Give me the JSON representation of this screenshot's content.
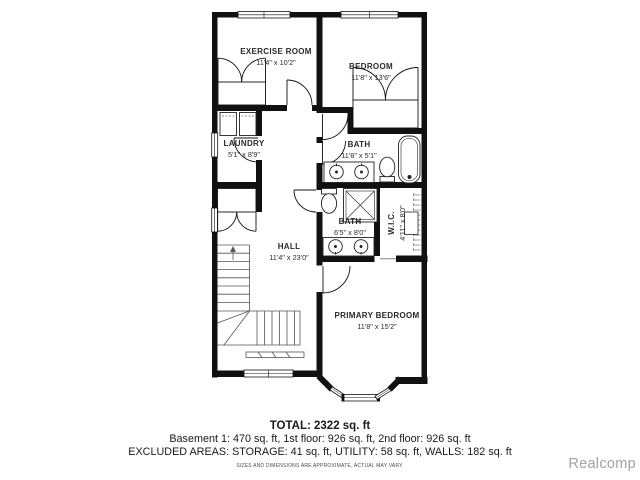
{
  "plan": {
    "rooms": {
      "exercise": {
        "name": "EXERCISE ROOM",
        "dims": "11'4\" x 10'2\""
      },
      "bedroom": {
        "name": "BEDROOM",
        "dims": "11'8\" x 13'6\""
      },
      "laundry": {
        "name": "LAUNDRY",
        "dims": "5'1\" x 8'9\""
      },
      "bath_upper": {
        "name": "BATH",
        "dims": "11'8\" x 5'1\""
      },
      "bath_lower": {
        "name": "BATH",
        "dims": "6'5\" x 8'0\""
      },
      "wic": {
        "name": "W.I.C.",
        "dims": "4'11\" x 8'0\""
      },
      "hall": {
        "name": "HALL",
        "dims": "11'4\" x 23'0\""
      },
      "primary": {
        "name": "PRIMARY BEDROOM",
        "dims": "11'8\" x 15'2\""
      }
    }
  },
  "footer": {
    "total": "TOTAL: 2322 sq. ft",
    "breakdown": "Basement 1: 470 sq. ft, 1st floor: 926 sq. ft, 2nd floor: 926 sq. ft",
    "excluded": "EXCLUDED AREAS: STORAGE: 41 sq. ft, UTILITY: 58 sq. ft, WALLS: 182 sq. ft",
    "disclaimer": "SIZES AND DIMENSIONS ARE APPROXIMATE, ACTUAL MAY VARY."
  },
  "watermark": "Realcomp",
  "colors": {
    "wall": "#111111",
    "text": "#2a2a2a",
    "watermark": "#a3a3a3"
  }
}
